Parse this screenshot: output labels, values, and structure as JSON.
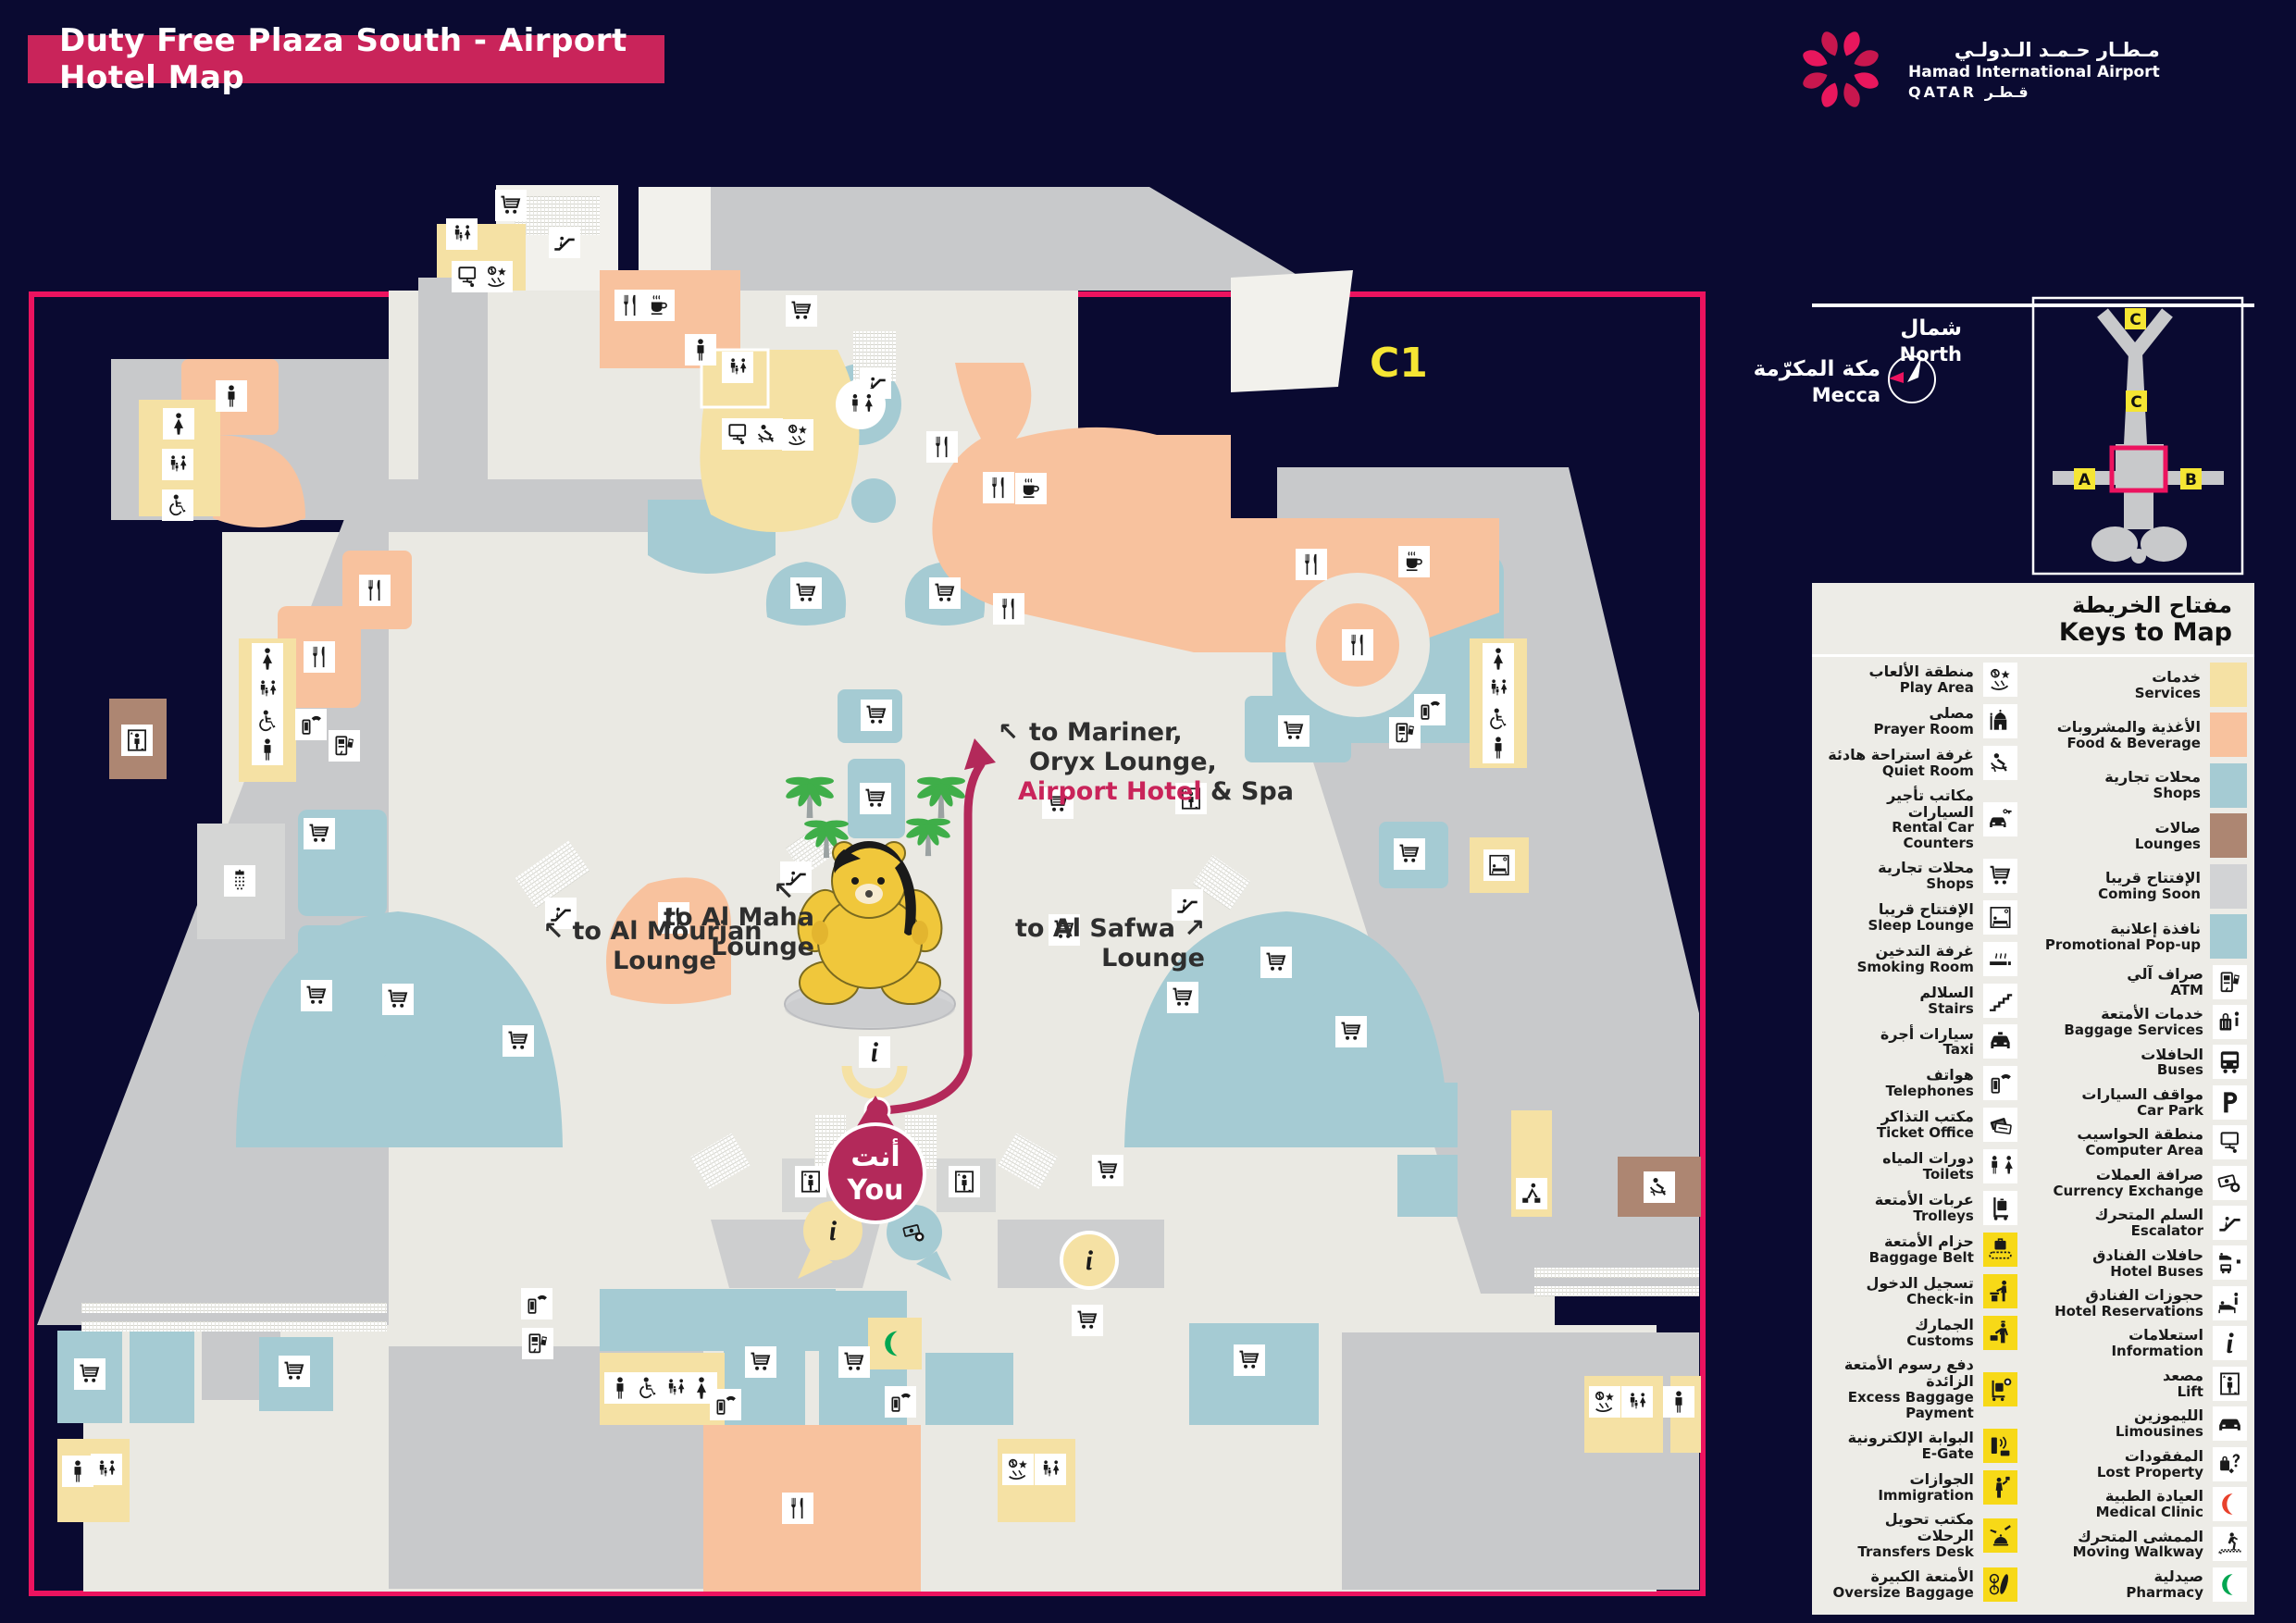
{
  "title": {
    "text": "Duty Free Plaza South -  Airport Hotel Map"
  },
  "logo": {
    "arabic": "مـطـار حـمـد الـدولـي",
    "english": "Hamad International Airport",
    "qatar": "QATAR قـطـر"
  },
  "compass": {
    "north_ar": "شمال",
    "north_en": "North",
    "mecca_ar": "مكة المكرّمة",
    "mecca_en": "Mecca"
  },
  "overview": {
    "labels": [
      "C",
      "C",
      "A",
      "B"
    ]
  },
  "map": {
    "zone_label": "C1",
    "you": {
      "ar": "أنت",
      "en": "You"
    },
    "annotations": {
      "mariner_arrow": "↖",
      "mariner_l1": "to Mariner,",
      "mariner_l2": "Oryx Lounge,",
      "mariner_l3_hl": "Airport Hotel",
      "mariner_l3_rest": " & Spa",
      "mourjan_l1": "↖ to Al Mourjan",
      "mourjan_l2": "Lounge",
      "maha_arrow": "↖",
      "maha_l1": "to Al Maha",
      "maha_l2": "Lounge",
      "safwa_l1": "to Al Safwa ↗",
      "safwa_l2": "Lounge"
    },
    "colors": {
      "frame": "#EC135F",
      "route": "#B3295A",
      "floor": "#EAE9E3",
      "concourse": "#C8C9CB",
      "teal": "#A5CBD3",
      "orange": "#F8C29E",
      "yellow": "#F5E1A4",
      "brown": "#AD8672",
      "zone_label": "#F5E533"
    },
    "icons": [
      [
        "cart",
        552,
        222
      ],
      [
        "family",
        499,
        253
      ],
      [
        "computer",
        505,
        299
      ],
      [
        "play",
        537,
        299
      ],
      [
        "escalator",
        610,
        262
      ],
      [
        "restaurant",
        681,
        330
      ],
      [
        "coffee",
        712,
        330
      ],
      [
        "man",
        757,
        378
      ],
      [
        "family",
        797,
        397
      ],
      [
        "computer",
        797,
        469
      ],
      [
        "quiet",
        829,
        469
      ],
      [
        "play",
        862,
        470
      ],
      [
        "escalator",
        946,
        414
      ],
      [
        "cart",
        866,
        336
      ],
      [
        "restaurant",
        1018,
        483
      ],
      [
        "restaurant",
        1079,
        527
      ],
      [
        "coffee",
        1114,
        528
      ],
      [
        "restaurant",
        1090,
        658
      ],
      [
        "restaurant",
        1417,
        610
      ],
      [
        "coffee",
        1528,
        607
      ],
      [
        "restaurant",
        1467,
        697
      ],
      [
        "man",
        250,
        428
      ],
      [
        "woman",
        193,
        458
      ],
      [
        "family",
        192,
        502
      ],
      [
        "accessible",
        192,
        546
      ],
      [
        "restaurant",
        405,
        638
      ],
      [
        "restaurant",
        345,
        710
      ],
      [
        "toilets",
        930,
        437
      ],
      [
        "woman",
        289,
        712
      ],
      [
        "family",
        289,
        745
      ],
      [
        "accessible",
        289,
        779
      ],
      [
        "man",
        289,
        810
      ],
      [
        "shower",
        259,
        952
      ],
      [
        "phone",
        336,
        783
      ],
      [
        "atm",
        372,
        806
      ],
      [
        "lift",
        148,
        800
      ],
      [
        "cart",
        345,
        901
      ],
      [
        "cart",
        342,
        1076
      ],
      [
        "cart",
        430,
        1080
      ],
      [
        "cart",
        560,
        1125
      ],
      [
        "cart",
        947,
        773
      ],
      [
        "cart",
        946,
        863
      ],
      [
        "cart",
        1143,
        868
      ],
      [
        "cart",
        1150,
        1005
      ],
      [
        "cart",
        871,
        641
      ],
      [
        "cart",
        1021,
        641
      ],
      [
        "restaurant",
        728,
        992
      ],
      [
        "escalator",
        606,
        987
      ],
      [
        "escalator",
        860,
        948
      ],
      [
        "escalator",
        1283,
        978
      ],
      [
        "lift",
        1287,
        863
      ],
      [
        "cart",
        1398,
        790
      ],
      [
        "cart",
        1523,
        923
      ],
      [
        "cart",
        1379,
        1040
      ],
      [
        "woman",
        1619,
        712
      ],
      [
        "family",
        1619,
        744
      ],
      [
        "accessible",
        1619,
        777
      ],
      [
        "man",
        1619,
        808
      ],
      [
        "phone",
        1545,
        767
      ],
      [
        "atm",
        1518,
        792
      ],
      [
        "sleep",
        1620,
        935
      ],
      [
        "porter",
        1655,
        1290
      ],
      [
        "quiet",
        1793,
        1283
      ],
      [
        "cart",
        1278,
        1078
      ],
      [
        "cart",
        1460,
        1115
      ],
      [
        "lift",
        876,
        1277
      ],
      [
        "lift",
        1042,
        1277
      ],
      [
        "info",
        900,
        1330,
        {
          "nobox": true
        }
      ],
      [
        "currency",
        988,
        1332,
        {
          "nobox": true
        }
      ],
      [
        "info",
        1177,
        1362,
        {
          "nobox": true
        }
      ],
      [
        "cart",
        1197,
        1265
      ],
      [
        "cart",
        1175,
        1427
      ],
      [
        "info",
        945,
        1137
      ],
      [
        "phone",
        580,
        1409
      ],
      [
        "atm",
        581,
        1452
      ],
      [
        "man",
        670,
        1500
      ],
      [
        "accessible",
        700,
        1500
      ],
      [
        "family",
        730,
        1500
      ],
      [
        "woman",
        758,
        1500
      ],
      [
        "phone",
        784,
        1518
      ],
      [
        "cart",
        822,
        1472
      ],
      [
        "cart",
        923,
        1472
      ],
      [
        "crescent",
        966,
        1452,
        {
          "nobox": true,
          "color": "#00A651",
          "size": 34
        }
      ],
      [
        "restaurant",
        862,
        1630
      ],
      [
        "phone",
        973,
        1515
      ],
      [
        "cart",
        1350,
        1470
      ],
      [
        "play",
        1734,
        1515
      ],
      [
        "family",
        1769,
        1515
      ],
      [
        "man",
        1814,
        1515
      ],
      [
        "man",
        84,
        1590
      ],
      [
        "family",
        115,
        1588
      ],
      [
        "cart",
        97,
        1485
      ],
      [
        "cart",
        318,
        1482
      ],
      [
        "play",
        1100,
        1588
      ],
      [
        "family",
        1135,
        1588
      ]
    ]
  },
  "legend": {
    "title_ar": "مفتاح الخريطة",
    "title_en": "Keys to Map",
    "left_items": [
      {
        "ar": "منطقة الألعاب",
        "en": "Play Area",
        "icon": "play"
      },
      {
        "ar": "مصلى",
        "en": "Prayer Room",
        "icon": "mosque"
      },
      {
        "ar": "غرفة استراحة هادئة",
        "en": "Quiet Room",
        "icon": "quiet"
      },
      {
        "ar": "مكاتب تأجير السيارات",
        "en": "Rental Car Counters",
        "icon": "carkey"
      },
      {
        "ar": "محلات تجارية",
        "en": "Shops",
        "icon": "cart"
      },
      {
        "ar": "الإفتتاح قريبا",
        "en": "Sleep Lounge",
        "icon": "sleep"
      },
      {
        "ar": "غرفة التدخين",
        "en": "Smoking Room",
        "icon": "smoking"
      },
      {
        "ar": "السلالم",
        "en": "Stairs",
        "icon": "stairs"
      },
      {
        "ar": "سيارات أجرة",
        "en": "Taxi",
        "icon": "taxi"
      },
      {
        "ar": "هواتف",
        "en": "Telephones",
        "icon": "phone"
      },
      {
        "ar": "مكتب التذاكر",
        "en": "Ticket Office",
        "icon": "tickets"
      },
      {
        "ar": "دورات المياه",
        "en": "Toilets",
        "icon": "toilets"
      },
      {
        "ar": "عربات الأمتعة",
        "en": "Trolleys",
        "icon": "trolley"
      },
      {
        "ar": "حزام الأمتعة",
        "en": "Baggage Belt",
        "icon": "bbelt",
        "bg": "yellow"
      },
      {
        "ar": "تسجيل الدخول",
        "en": "Check-in",
        "icon": "checkin",
        "bg": "yellow"
      },
      {
        "ar": "الجمارك",
        "en": "Customs",
        "icon": "customs",
        "bg": "yellow"
      },
      {
        "ar": "دفع رسوم الأمتعة الزائدة",
        "en": "Excess Baggage Payment",
        "icon": "excess",
        "bg": "yellow"
      },
      {
        "ar": "البوابة الإلكترونية",
        "en": "E-Gate",
        "icon": "egate",
        "bg": "yellow"
      },
      {
        "ar": "الجوازات",
        "en": "Immigration",
        "icon": "immigration",
        "bg": "yellow"
      },
      {
        "ar": "مكتب تحويل الرحلات",
        "en": "Transfers Desk",
        "icon": "transfers",
        "bg": "yellow"
      },
      {
        "ar": "الأمتعة الكبيرة",
        "en": "Oversize Baggage",
        "icon": "oversize",
        "bg": "yellow"
      }
    ],
    "right_items": [
      {
        "ar": "خدمات",
        "en": "Services",
        "swatch": "#F5E1A4"
      },
      {
        "ar": "الأغذية والمشروبات",
        "en": "Food & Beverage",
        "swatch": "#F8C29E"
      },
      {
        "ar": "محلات تجارية",
        "en": "Shops",
        "swatch": "#A5CBD3"
      },
      {
        "ar": "صالات",
        "en": "Lounges",
        "swatch": "#AD8672"
      },
      {
        "ar": "الإفتتاح قريبا",
        "en": "Coming Soon",
        "swatch": "#D2D3D5"
      },
      {
        "ar": "نافذة إعلانية",
        "en": "Promotional Pop-up",
        "swatch": "#A5CBD3"
      },
      {
        "ar": "صراف آلي",
        "en": "ATM",
        "icon": "atm"
      },
      {
        "ar": "خدمات الأمتعة",
        "en": "Baggage Services",
        "icon": "bagservices"
      },
      {
        "ar": "الحافلات",
        "en": "Buses",
        "icon": "bus"
      },
      {
        "ar": "مواقف السيارات",
        "en": "Car Park",
        "icon": "p"
      },
      {
        "ar": "منطقة الحواسيب",
        "en": "Computer Area",
        "icon": "computer"
      },
      {
        "ar": "صرافة العملات",
        "en": "Currency Exchange",
        "icon": "currency"
      },
      {
        "ar": "السلم المتحرك",
        "en": "Escalator",
        "icon": "escalator"
      },
      {
        "ar": "حافلات الفنادق",
        "en": "Hotel Buses",
        "icon": "hotelbus"
      },
      {
        "ar": "حجوزات الفنادق",
        "en": "Hotel Reservations",
        "icon": "hotelres"
      },
      {
        "ar": "استعلامات",
        "en": "Information",
        "icon": "info"
      },
      {
        "ar": "مصعد",
        "en": "Lift",
        "icon": "lift"
      },
      {
        "ar": "الليموزين",
        "en": "Limousines",
        "icon": "limo"
      },
      {
        "ar": "المفقودات",
        "en": "Lost Property",
        "icon": "lost"
      },
      {
        "ar": "العيادة الطبية",
        "en": "Medical Clinic",
        "icon": "crescent",
        "color": "#E8412C"
      },
      {
        "ar": "الممشى المتحرك",
        "en": "Moving Walkway",
        "icon": "walkway"
      },
      {
        "ar": "صيدلية",
        "en": "Pharmacy",
        "icon": "crescent",
        "color": "#00A651"
      }
    ]
  }
}
